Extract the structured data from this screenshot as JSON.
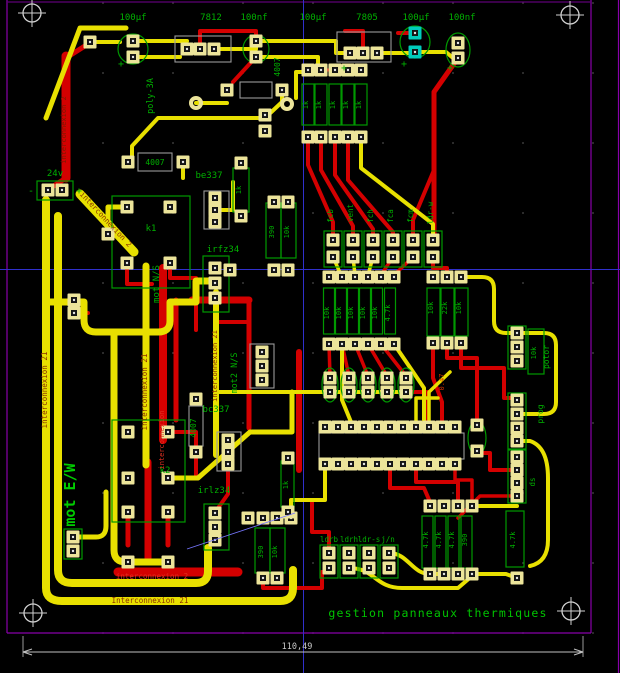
{
  "app": {
    "type": "pcb-layout-viewer",
    "board_title": "gestion panneaux thermiques",
    "dimension_label": "110,49"
  },
  "colors": {
    "background": "#000000",
    "copper_top_yellow": "#e8e000",
    "copper_bottom_red": "#d40000",
    "silkscreen_green": "#00b000",
    "pad_khaki": "#ece49a",
    "pad_highlight_teal": "#00ccbb",
    "footprint_outline_gray": "#9a9a9a",
    "board_edge_purple": "#8800aa",
    "axis_blue": "#3030cc",
    "dimension_gray": "#c8c8c8",
    "trace_text_dark": "#8a2e00"
  },
  "labels": [
    {
      "t": "100µf",
      "x": 133,
      "y": 20
    },
    {
      "t": "7812",
      "x": 211,
      "y": 20
    },
    {
      "t": "100nf",
      "x": 254,
      "y": 20
    },
    {
      "t": "100µf",
      "x": 313,
      "y": 20
    },
    {
      "t": "7805",
      "x": 367,
      "y": 20
    },
    {
      "t": "100µf",
      "x": 416,
      "y": 20
    },
    {
      "t": "100nf",
      "x": 462,
      "y": 20
    },
    {
      "t": "poly-3A",
      "x": 153,
      "y": 96,
      "r": -90,
      "s": 8.5
    },
    {
      "t": "4007",
      "x": 280,
      "y": 67,
      "r": -90,
      "s": 8
    },
    {
      "t": "1k",
      "x": 308,
      "y": 105,
      "r": -90,
      "s": 7
    },
    {
      "t": "1k",
      "x": 321,
      "y": 105,
      "r": -90,
      "s": 7
    },
    {
      "t": "1k",
      "x": 335,
      "y": 105,
      "r": -90,
      "s": 7
    },
    {
      "t": "1k",
      "x": 348,
      "y": 105,
      "r": -90,
      "s": 7
    },
    {
      "t": "1k",
      "x": 361,
      "y": 105,
      "r": -90,
      "s": 7
    },
    {
      "t": "4007",
      "x": 155,
      "y": 165,
      "s": 8
    },
    {
      "t": "be337",
      "x": 209,
      "y": 178
    },
    {
      "t": "1k",
      "x": 241,
      "y": 190,
      "r": -90,
      "s": 7
    },
    {
      "t": "24v",
      "x": 55,
      "y": 176
    },
    {
      "t": "-",
      "x": 31,
      "y": 194,
      "s": 10
    },
    {
      "t": "+",
      "x": 79,
      "y": 194,
      "s": 10
    },
    {
      "t": "+",
      "x": 121,
      "y": 67,
      "s": 10
    },
    {
      "t": "+",
      "x": 344,
      "y": 71,
      "s": 10
    },
    {
      "t": "+",
      "x": 404,
      "y": 67,
      "s": 10
    },
    {
      "t": "+",
      "x": 450,
      "y": 71,
      "s": 10
    },
    {
      "t": "k1",
      "x": 151,
      "y": 231
    },
    {
      "t": "irfz34",
      "x": 223,
      "y": 252
    },
    {
      "t": "390",
      "x": 274,
      "y": 232,
      "r": -90,
      "s": 7
    },
    {
      "t": "10k",
      "x": 289,
      "y": 232,
      "r": -90,
      "s": 7
    },
    {
      "t": "fcb",
      "x": 333,
      "y": 216,
      "r": -90,
      "s": 7.5
    },
    {
      "t": "vent",
      "x": 353,
      "y": 213,
      "r": -90,
      "s": 7.5
    },
    {
      "t": "fch",
      "x": 373,
      "y": 216,
      "r": -90,
      "s": 7.5
    },
    {
      "t": "fca",
      "x": 393,
      "y": 216,
      "r": -90,
      "s": 7.5
    },
    {
      "t": "fcm",
      "x": 413,
      "y": 216,
      "r": -90,
      "s": 7.5
    },
    {
      "t": "ldr-w",
      "x": 433,
      "y": 213,
      "r": -90,
      "s": 7.5
    },
    {
      "t": "10k",
      "x": 329,
      "y": 313,
      "r": -90,
      "s": 7
    },
    {
      "t": "10k",
      "x": 341,
      "y": 313,
      "r": -90,
      "s": 7
    },
    {
      "t": "10k",
      "x": 353,
      "y": 313,
      "r": -90,
      "s": 7
    },
    {
      "t": "10k",
      "x": 365,
      "y": 313,
      "r": -90,
      "s": 7
    },
    {
      "t": "10k",
      "x": 377,
      "y": 313,
      "r": -90,
      "s": 7
    },
    {
      "t": "4.7k",
      "x": 390,
      "y": 313,
      "r": -90,
      "s": 7
    },
    {
      "t": "10k",
      "x": 433,
      "y": 308,
      "r": -90,
      "s": 7
    },
    {
      "t": "22k",
      "x": 447,
      "y": 308,
      "r": -90,
      "s": 7
    },
    {
      "t": "10k",
      "x": 461,
      "y": 308,
      "r": -90,
      "s": 7
    },
    {
      "t": "0.47",
      "x": 444,
      "y": 382,
      "r": -90,
      "s": 7,
      "c": "#cc3000"
    },
    {
      "t": "mot N/S",
      "x": 159,
      "y": 284,
      "r": -90,
      "s": 9
    },
    {
      "t": "mot2 N/S",
      "x": 237,
      "y": 373,
      "r": -90,
      "s": 8.5
    },
    {
      "t": "mot E/W",
      "x": 75,
      "y": 495,
      "r": -90,
      "s": 15,
      "c": "#00cc00",
      "w": 1
    },
    {
      "t": "4007",
      "x": 196,
      "y": 428,
      "r": -90,
      "s": 8
    },
    {
      "t": "bc337",
      "x": 216,
      "y": 412
    },
    {
      "t": "k2",
      "x": 165,
      "y": 473
    },
    {
      "t": "irlz34",
      "x": 214,
      "y": 493
    },
    {
      "t": "1k",
      "x": 288,
      "y": 485,
      "r": -90,
      "s": 7
    },
    {
      "t": "390",
      "x": 263,
      "y": 552,
      "r": -90,
      "s": 7
    },
    {
      "t": "10k",
      "x": 277,
      "y": 552,
      "r": -90,
      "s": 7
    },
    {
      "t": "10k",
      "x": 536,
      "y": 353,
      "r": -90,
      "s": 7
    },
    {
      "t": "potor",
      "x": 549,
      "y": 357,
      "r": -90,
      "s": 8
    },
    {
      "t": "prog",
      "x": 543,
      "y": 414,
      "r": -90,
      "s": 8
    },
    {
      "t": "ds",
      "x": 535,
      "y": 482,
      "r": -90,
      "s": 7.5
    },
    {
      "t": "4.7k",
      "x": 515,
      "y": 540,
      "r": -90,
      "s": 7
    },
    {
      "t": "4.7k",
      "x": 428,
      "y": 540,
      "r": -90,
      "s": 7
    },
    {
      "t": "4.7k",
      "x": 441,
      "y": 540,
      "r": -90,
      "s": 7
    },
    {
      "t": "4.7k",
      "x": 454,
      "y": 540,
      "r": -90,
      "s": 7
    },
    {
      "t": "390",
      "x": 467,
      "y": 540,
      "r": -90,
      "s": 7
    },
    {
      "t": "ldrb",
      "x": 329,
      "y": 542,
      "s": 7.5
    },
    {
      "t": "ldrh",
      "x": 349,
      "y": 542,
      "s": 7.5
    },
    {
      "t": "ldr-s",
      "x": 369,
      "y": 542,
      "s": 7.5
    },
    {
      "t": "j/n",
      "x": 388,
      "y": 542,
      "s": 7.5
    },
    {
      "t": "interconnexion 21",
      "x": 47,
      "y": 390,
      "r": -90,
      "s": 7.5,
      "c": "#8a2e00"
    },
    {
      "t": "interconnexion 21",
      "x": 147,
      "y": 392,
      "r": -90,
      "s": 7.5,
      "c": "#8a2e00"
    },
    {
      "t": "interconnexion 21",
      "x": 217,
      "y": 366,
      "r": -90,
      "s": 7,
      "c": "#8a2e00"
    },
    {
      "t": "interconnexion 2",
      "x": 104,
      "y": 221,
      "r": 47,
      "s": 7.5,
      "c": "#8a2e00"
    },
    {
      "t": "Interconnexion 21",
      "x": 150,
      "y": 603,
      "s": 7.5,
      "c": "#8a2e00"
    },
    {
      "t": "interconnexion 2",
      "x": 152,
      "y": 579,
      "s": 7.5,
      "c": "#e03020"
    },
    {
      "t": "interconnexion",
      "x": 164,
      "y": 440,
      "r": -90,
      "s": 7,
      "c": "#e03020"
    },
    {
      "t": "interconnexion 2",
      "x": 66,
      "y": 130,
      "r": -90,
      "s": 7,
      "c": "#7a1800"
    },
    {
      "t": "gestion panneaux thermiques",
      "x": 438,
      "y": 617,
      "s": 11.5,
      "c": "#00c400",
      "ls": 1.2
    },
    {
      "t": "110,49",
      "x": 297,
      "y": 649,
      "s": 8.5,
      "c": "#c8c8c8"
    }
  ]
}
